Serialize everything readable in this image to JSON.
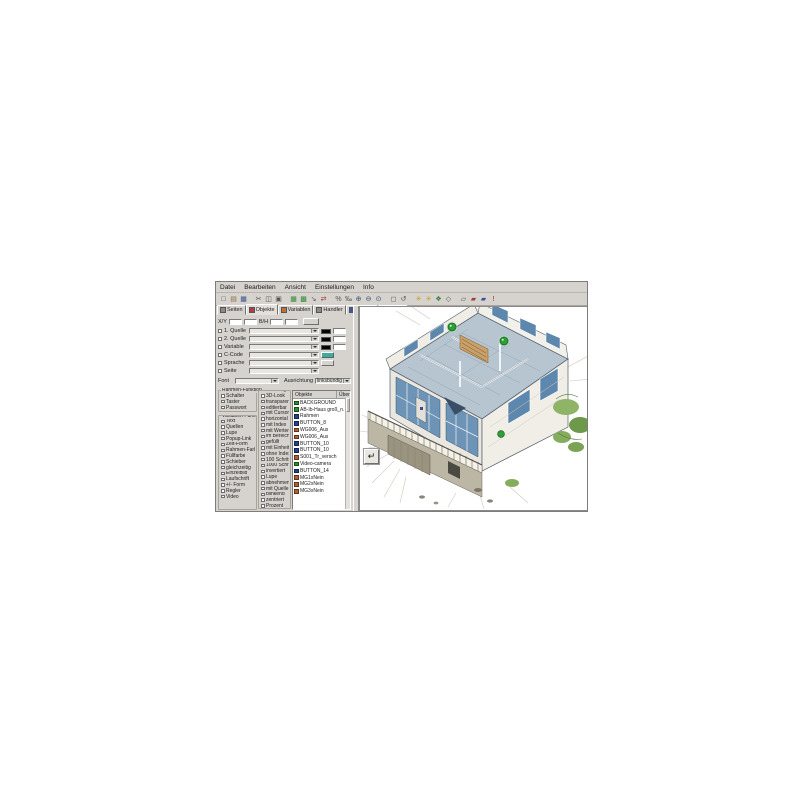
{
  "window": {
    "bg": "#d6d3ce",
    "accent_green": "#2f9e38"
  },
  "menu": {
    "items": [
      {
        "label": "Datei"
      },
      {
        "label": "Bearbeiten"
      },
      {
        "label": "Ansicht"
      },
      {
        "label": "Einstellungen"
      },
      {
        "label": "Info"
      }
    ]
  },
  "toolbar": {
    "icons": [
      {
        "name": "new-file-icon",
        "glyph": "□",
        "color": "#4a4a4a",
        "sep": false
      },
      {
        "name": "open-folder-icon",
        "glyph": "▤",
        "color": "#8a6d3b",
        "sep": false
      },
      {
        "name": "save-icon",
        "glyph": "▦",
        "color": "#35508a",
        "sep": true
      },
      {
        "name": "cut-icon",
        "glyph": "✂",
        "color": "#555555",
        "sep": false
      },
      {
        "name": "copy-icon",
        "glyph": "◫",
        "color": "#555555",
        "sep": false
      },
      {
        "name": "paste-icon",
        "glyph": "▣",
        "color": "#555555",
        "sep": true
      },
      {
        "name": "objects-grid-icon",
        "glyph": "▦",
        "color": "#2f8a2f",
        "sep": false
      },
      {
        "name": "layers-icon",
        "glyph": "▩",
        "color": "#2f8a2f",
        "sep": false
      },
      {
        "name": "arrow-tool-icon",
        "glyph": "↘",
        "color": "#555555",
        "sep": false
      },
      {
        "name": "swap-icon",
        "glyph": "⇄",
        "color": "#a03030",
        "sep": true
      },
      {
        "name": "percent-icon",
        "glyph": "%",
        "color": "#555555",
        "sep": false
      },
      {
        "name": "permille-icon",
        "glyph": "‰",
        "color": "#555555",
        "sep": false
      },
      {
        "name": "zoom-in-icon",
        "glyph": "⊕",
        "color": "#33506e",
        "sep": false
      },
      {
        "name": "zoom-out-icon",
        "glyph": "⊖",
        "color": "#33506e",
        "sep": false
      },
      {
        "name": "zoom-fit-icon",
        "glyph": "⊙",
        "color": "#33506e",
        "sep": true
      },
      {
        "name": "frame-icon",
        "glyph": "◻",
        "color": "#555555",
        "sep": false
      },
      {
        "name": "undo-icon",
        "glyph": "↺",
        "color": "#555555",
        "sep": true
      },
      {
        "name": "star-icon",
        "glyph": "✳",
        "color": "#c8a020",
        "sep": false
      },
      {
        "name": "star2-icon",
        "glyph": "✳",
        "color": "#c8a020",
        "sep": false
      },
      {
        "name": "diamond-icon",
        "glyph": "❖",
        "color": "#3a7a3a",
        "sep": false
      },
      {
        "name": "outline-icon",
        "glyph": "◇",
        "color": "#555555",
        "sep": true
      },
      {
        "name": "panel-icon",
        "glyph": "▱",
        "color": "#555555",
        "sep": false
      },
      {
        "name": "red-block-icon",
        "glyph": "▰",
        "color": "#a04040",
        "sep": false
      },
      {
        "name": "blue-block-icon",
        "glyph": "▰",
        "color": "#4050a0",
        "sep": false
      },
      {
        "name": "alert-icon",
        "glyph": "!",
        "color": "#b02020",
        "sep": false
      }
    ]
  },
  "tabs": [
    {
      "label": "Seiten",
      "icon_color": "#8a8a8a",
      "active": false
    },
    {
      "label": "Objekte",
      "icon_color": "#b04040",
      "active": true
    },
    {
      "label": "Variablen",
      "icon_color": "#c07030",
      "active": false
    },
    {
      "label": "Handler",
      "icon_color": "#8a8a8a",
      "active": false
    },
    {
      "label": "Quellen",
      "icon_color": "#3a5aa0",
      "active": false
    },
    {
      "label": "Alarme",
      "icon_color": "#707070",
      "active": false
    }
  ],
  "properties": {
    "xy_label": "X/Y",
    "bh_label": "B/H",
    "rows": [
      {
        "label": "1. Quelle",
        "swatch": "#000000",
        "btn": "field"
      },
      {
        "label": "2. Quelle",
        "swatch": "#000000",
        "btn": "field"
      },
      {
        "label": "Variable",
        "swatch": "#000000",
        "btn": "field"
      },
      {
        "label": "C-Code",
        "swatch": "",
        "btn": "teal"
      },
      {
        "label": "Sprache",
        "swatch": "",
        "btn": "grey"
      },
      {
        "label": "Seite",
        "swatch": "",
        "btn": ""
      }
    ],
    "font_label": "Font",
    "align_label": "Ausrichtung",
    "align_value": "linksbündig",
    "groups": {
      "rahmen": {
        "title": "Rahmen-Funktion",
        "items": [
          {
            "label": "Schalter"
          },
          {
            "label": "Taster"
          },
          {
            "label": "Passwort"
          }
        ]
      },
      "variablen": {
        "title": "Variablen-Funk.",
        "items": [
          {
            "label": "Text"
          },
          {
            "label": "Quellen"
          },
          {
            "label": "Lupe"
          },
          {
            "label": "Popup-Link"
          },
          {
            "label": "Zeit-Form"
          },
          {
            "label": "Rahmen-Farbe"
          },
          {
            "label": "Füllfarbe"
          },
          {
            "label": "Schieber"
          },
          {
            "label": "gleichzeitig"
          },
          {
            "label": "Einzelbild"
          },
          {
            "label": "Laufschrift"
          },
          {
            "label": "+/- Form"
          },
          {
            "label": "Regler"
          },
          {
            "label": "Video"
          }
        ]
      },
      "gestaltung": {
        "title": "Gestaltung",
        "items": [
          {
            "label": "3D-Look"
          },
          {
            "label": "transparent"
          },
          {
            "label": "editierbar"
          },
          {
            "label": "mit Cursor"
          },
          {
            "label": "horizontal"
          },
          {
            "label": "mit Index"
          },
          {
            "label": "mit Werten"
          },
          {
            "label": "im Bereich"
          },
          {
            "label": "gefüllt"
          },
          {
            "label": "mit Einheit"
          },
          {
            "label": "ohne Index"
          },
          {
            "label": "100 Schritte"
          },
          {
            "label": "1000 Schritte"
          },
          {
            "label": "invertiert"
          },
          {
            "label": "Lupe"
          },
          {
            "label": "abnehmend"
          },
          {
            "label": "mit Quelle"
          },
          {
            "label": "blinkend"
          },
          {
            "label": "zentriert"
          },
          {
            "label": "Prozent"
          },
          {
            "label": "bewegbar"
          },
          {
            "label": "kein Prozent"
          }
        ]
      }
    }
  },
  "objects": {
    "header": "Objekte",
    "header2": "Über",
    "items": [
      {
        "label": "BACKGROUND",
        "color": "#2e8b2e"
      },
      {
        "label": "AB-Ib-Haus groß_n.",
        "color": "#2e8b2e"
      },
      {
        "label": "Rahmen",
        "color": "#27408b"
      },
      {
        "label": "BUTTON_8",
        "color": "#27408b"
      },
      {
        "label": "WG006_Aus",
        "color": "#b06030"
      },
      {
        "label": "WG006_Aus",
        "color": "#b06030"
      },
      {
        "label": "BUTTON_10",
        "color": "#27408b"
      },
      {
        "label": "BUTTON_10",
        "color": "#27408b"
      },
      {
        "label": "S001_Tr_versch",
        "color": "#b06030"
      },
      {
        "label": "Video-camera",
        "color": "#2e8b2e"
      },
      {
        "label": "BUTTON_14",
        "color": "#27408b"
      },
      {
        "label": "MG1xNein",
        "color": "#b06030"
      },
      {
        "label": "MG2xNein",
        "color": "#b06030"
      },
      {
        "label": "MG3xNein",
        "color": "#b06030"
      }
    ]
  },
  "canvas": {
    "return_button_glyph": "↵"
  }
}
